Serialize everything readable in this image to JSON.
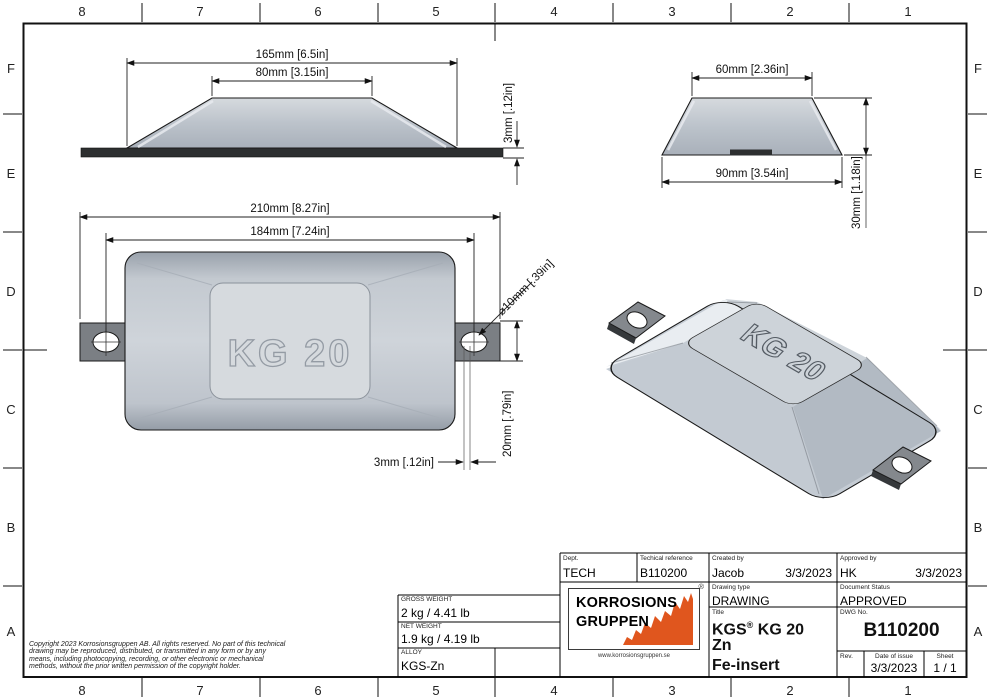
{
  "frame": {
    "columns": [
      "8",
      "7",
      "6",
      "5",
      "4",
      "3",
      "2",
      "1"
    ],
    "rows": [
      "F",
      "E",
      "D",
      "C",
      "B",
      "A"
    ]
  },
  "views": {
    "front": {
      "dim_width": "165mm [6.5in]",
      "dim_top": "80mm [3.15in]",
      "dim_insert": "3mm [.12in]"
    },
    "side": {
      "dim_top": "60mm [2.36in]",
      "dim_bottom": "90mm [3.54in]",
      "dim_height": "30mm [1.18in]"
    },
    "plan": {
      "engraving": "KG 20",
      "dim_overall": "210mm [8.27in]",
      "dim_hole_span": "184mm [7.24in]",
      "dim_hole_dia": "⌀10mm [.39in]",
      "dim_tab": "20mm [.79in]",
      "dim_insert": "3mm [.12in]"
    },
    "iso": {
      "engraving": "KG 20"
    }
  },
  "title_block": {
    "dept_label": "Dept.",
    "dept": "TECH",
    "tech_ref_label": "Techical reference",
    "tech_ref": "B110200",
    "created_label": "Created by",
    "created_by": "Jacob",
    "created_date": "3/3/2023",
    "approved_label": "Approved by",
    "approved_by": "HK",
    "approved_date": "3/3/2023",
    "drawing_type_label": "Drawing type",
    "drawing_type": "DRAWING",
    "doc_status_label": "Document Status",
    "doc_status": "APPROVED",
    "title_label": "Title",
    "title_brand": "KGS",
    "title_mark": "®",
    "title_rest": "KG 20",
    "title_line2": "Zn",
    "title_line3": "Fe-insert",
    "dwg_label": "DWG No.",
    "dwg_no": "B110200",
    "rev_label": "Rev.",
    "rev": "",
    "issue_label": "Date of issue",
    "issue_date": "3/3/2023",
    "sheet_label": "Sheet",
    "sheet_no": "1 / 1",
    "gross_label": "GROSS WEIGHT",
    "gross": "2 kg / 4.41 lb",
    "net_label": "NET WEIGHT",
    "net": "1.9 kg / 4.19 lb",
    "alloy_label": "ALLOY",
    "alloy": "KGS-Zn"
  },
  "logo": {
    "line1": "KORROSIONS",
    "line2": "GRUPPEN",
    "mark": "®",
    "website": "www.korrosionsgruppen.se",
    "accent": "#E0561E"
  },
  "copyright": "Copyright 2023 Korrosionsgruppen AB. All rights reserved. No part of this technical drawing may be reproduced, distributed, or transmitted in any form or by any means, including photocopying, recording, or other electronic or mechanical methods, without the prior written permission of the copyright holder.",
  "colors": {
    "body_gray": "#BCC3CC",
    "insert_dark": "#2D2F30",
    "tab_gray": "#7B7F84",
    "accent_orange": "#E0561E"
  }
}
